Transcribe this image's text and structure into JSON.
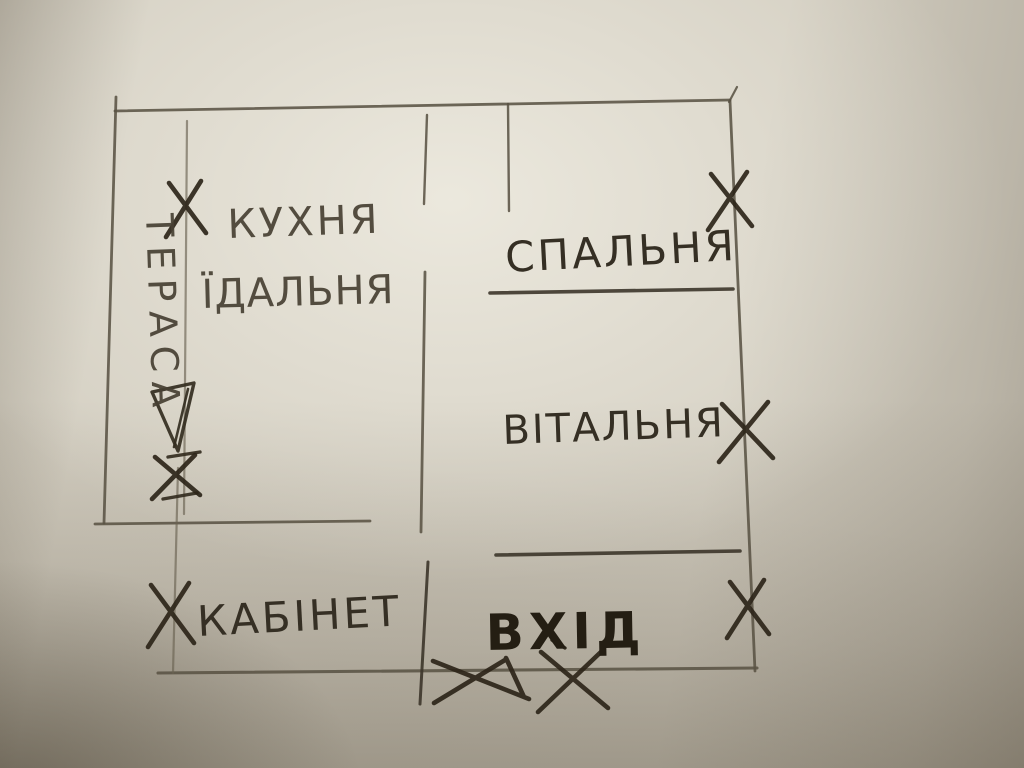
{
  "colors": {
    "paper": "#d4cfc2",
    "paper_highlight": "#e2ded3",
    "paper_shadow": "#8f8575",
    "pencil_wall": "#5a5344",
    "pencil_dark": "#2c2519"
  },
  "rooms": [
    {
      "id": "terrace",
      "label": "ТЕРАСА"
    },
    {
      "id": "kitchen",
      "label": "КУХНЯ"
    },
    {
      "id": "dining",
      "label": "ЇДАЛЬНЯ"
    },
    {
      "id": "bedroom",
      "label": "СПАЛЬНЯ"
    },
    {
      "id": "living-room",
      "label": "ВІТАЛЬНЯ"
    },
    {
      "id": "office",
      "label": "КАБІНЕТ"
    },
    {
      "id": "entrance",
      "label": "ВХІД"
    }
  ],
  "marks": [
    {
      "name": "x-mark-terrace-kitchen-wall",
      "cx": 186,
      "cy": 209,
      "w": 40,
      "h": 56
    },
    {
      "name": "x-mark-terrace-door",
      "cx": 176,
      "cy": 477,
      "w": 48,
      "h": 44
    },
    {
      "name": "x-mark-bedroom-right-wall",
      "cx": 730,
      "cy": 201,
      "w": 44,
      "h": 58
    },
    {
      "name": "x-mark-living-room-right-wall",
      "cx": 746,
      "cy": 432,
      "w": 54,
      "h": 60
    },
    {
      "name": "x-mark-bottom-right-wall",
      "cx": 748,
      "cy": 609,
      "w": 42,
      "h": 58
    },
    {
      "name": "x-mark-office-left-wall",
      "cx": 171,
      "cy": 615,
      "w": 46,
      "h": 64
    },
    {
      "name": "x-mark-entrance-threshold",
      "cx": 573,
      "cy": 681,
      "w": 70,
      "h": 62
    }
  ]
}
